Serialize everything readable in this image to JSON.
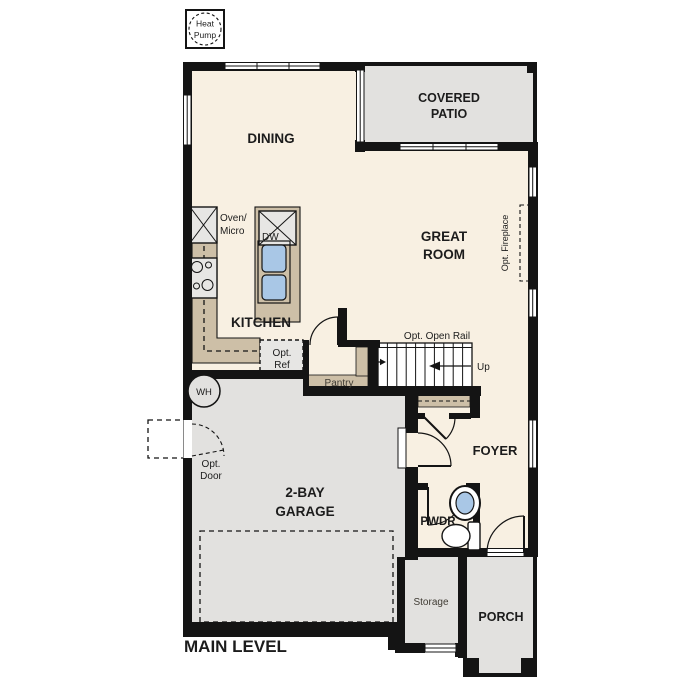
{
  "title": {
    "main_level": "MAIN LEVEL"
  },
  "rooms": {
    "dining": "DINING",
    "covered_patio": [
      "COVERED",
      "PATIO"
    ],
    "great_room": [
      "GREAT",
      "ROOM"
    ],
    "kitchen": "KITCHEN",
    "garage": [
      "2-BAY",
      "GARAGE"
    ],
    "foyer": "FOYER",
    "pwdr": "PWDR",
    "porch": "PORCH",
    "storage": "Storage",
    "pantry": "Pantry"
  },
  "labels": {
    "heat_pump": [
      "Heat",
      "Pump"
    ],
    "oven_micro": [
      "Oven/",
      "Micro"
    ],
    "dishwasher": "DW",
    "opt_ref": [
      "Opt.",
      "Ref"
    ],
    "opt_open_rail": "Opt. Open Rail",
    "up": "Up",
    "opt_fireplace": "Opt. Fireplace",
    "water_heater": "WH",
    "opt_door": [
      "Opt.",
      "Door"
    ]
  },
  "colors": {
    "floor_interior": "#f8f0e2",
    "floor_exterior": "#e2e1df",
    "counter": "#cdbfa7",
    "fixture_gray": "#e7e6e4",
    "sink_blue": "#a9c7e6",
    "wall": "#141414",
    "text": "#1c1c1c",
    "text_soft": "#3f3b33"
  }
}
